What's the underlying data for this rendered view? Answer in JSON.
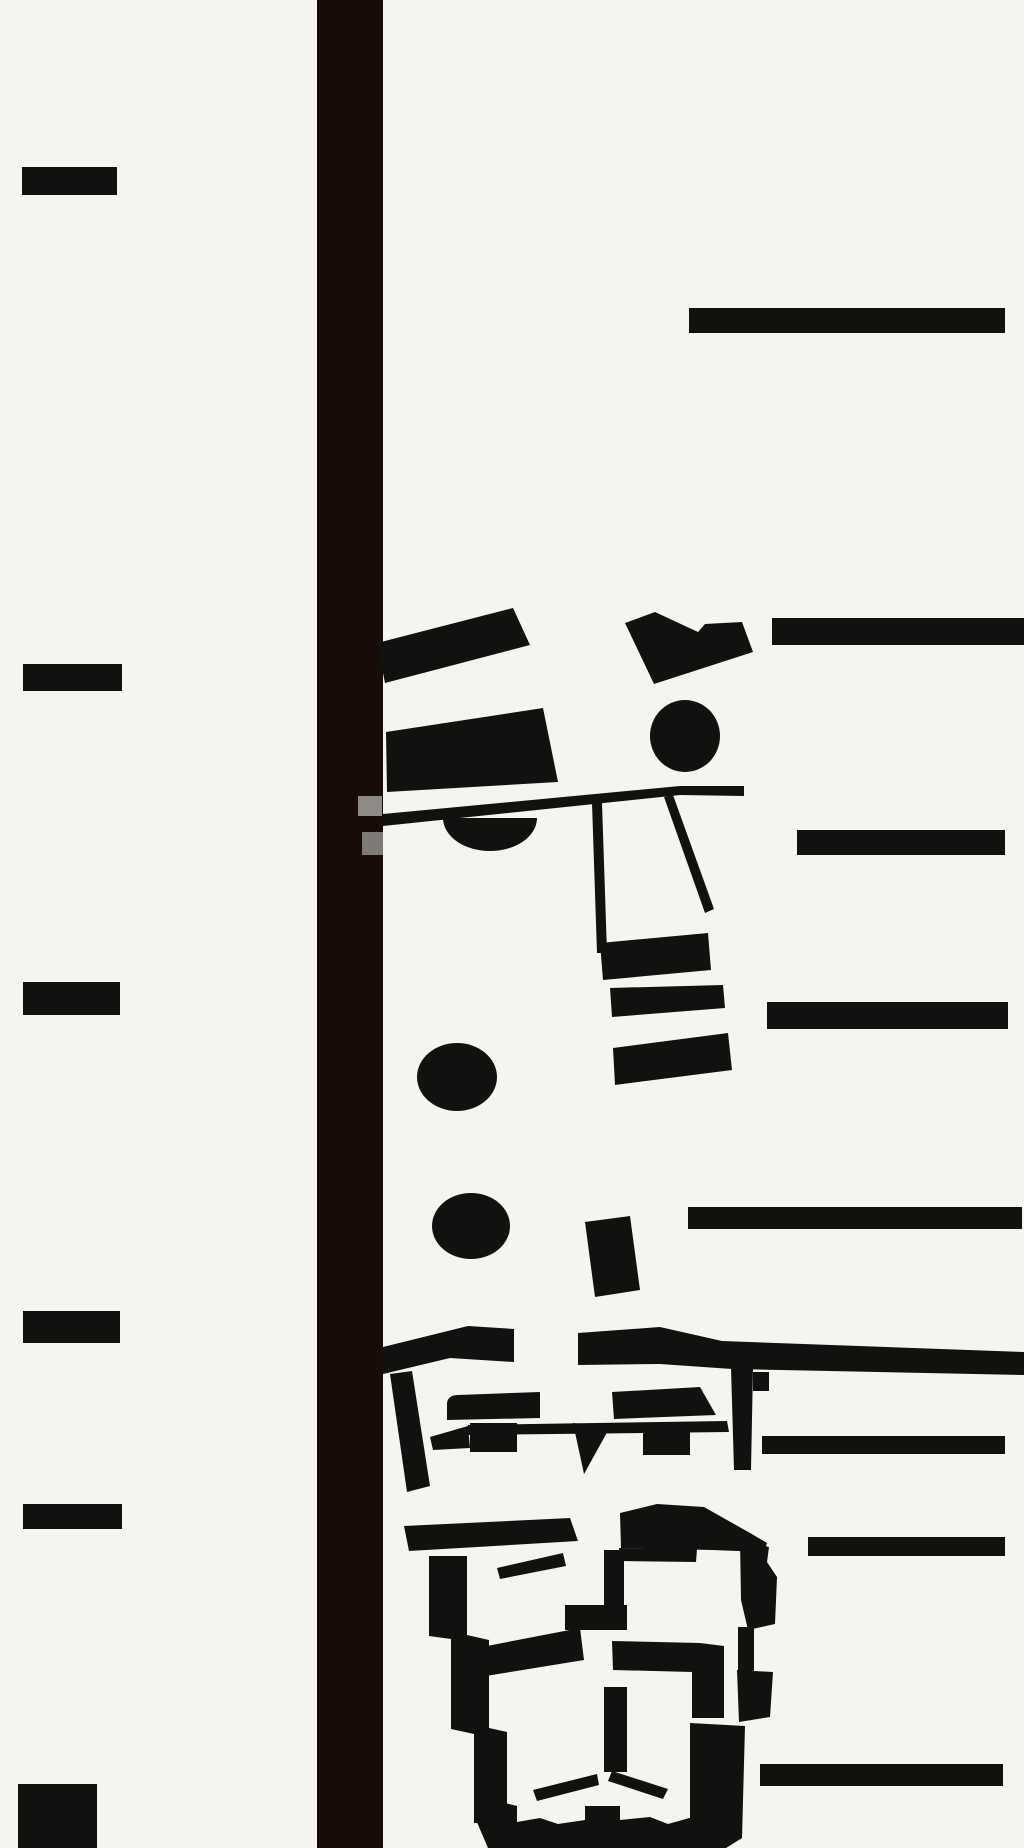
{
  "canvas": {
    "width": 1024,
    "height": 1848
  },
  "palette": {
    "background": "#f5f4f1",
    "ink": "#121110",
    "bar": "#170c08",
    "gray1": "#8e8b87",
    "gray2": "#7e7a76"
  },
  "shapes": [
    {
      "name": "left-tick-1",
      "kind": "rect",
      "x": 22,
      "y": 167,
      "w": 95,
      "h": 28
    },
    {
      "name": "left-tick-2",
      "kind": "rect",
      "x": 23,
      "y": 664,
      "w": 99,
      "h": 27
    },
    {
      "name": "left-tick-3",
      "kind": "rect",
      "x": 23,
      "y": 982,
      "w": 97,
      "h": 33
    },
    {
      "name": "left-tick-4",
      "kind": "rect",
      "x": 23,
      "y": 1311,
      "w": 97,
      "h": 32
    },
    {
      "name": "left-tick-5",
      "kind": "rect",
      "x": 23,
      "y": 1504,
      "w": 99,
      "h": 25
    },
    {
      "name": "left-corner-square",
      "kind": "rect",
      "x": 18,
      "y": 1784,
      "w": 79,
      "h": 64
    },
    {
      "name": "vertical-bar",
      "kind": "rect",
      "x": 317,
      "y": 0,
      "w": 66,
      "h": 1848,
      "fill": "bar"
    },
    {
      "name": "right-bar-1",
      "kind": "rect",
      "x": 689,
      "y": 308,
      "w": 316,
      "h": 25
    },
    {
      "name": "right-bar-2",
      "kind": "rect",
      "x": 772,
      "y": 618,
      "w": 252,
      "h": 27
    },
    {
      "name": "right-bar-3",
      "kind": "rect",
      "x": 797,
      "y": 830,
      "w": 208,
      "h": 25
    },
    {
      "name": "right-bar-4",
      "kind": "rect",
      "x": 767,
      "y": 1002,
      "w": 241,
      "h": 27
    },
    {
      "name": "right-bar-5",
      "kind": "rect",
      "x": 688,
      "y": 1207,
      "w": 334,
      "h": 22
    },
    {
      "name": "right-bar-6",
      "kind": "rect",
      "x": 762,
      "y": 1436,
      "w": 243,
      "h": 18
    },
    {
      "name": "right-bar-7",
      "kind": "rect",
      "x": 808,
      "y": 1537,
      "w": 197,
      "h": 19
    },
    {
      "name": "right-bar-8",
      "kind": "rect",
      "x": 760,
      "y": 1764,
      "w": 243,
      "h": 22
    },
    {
      "name": "face1-brow",
      "kind": "poly",
      "pts": [
        [
          377,
          643
        ],
        [
          513,
          608
        ],
        [
          530,
          645
        ],
        [
          385,
          683
        ]
      ]
    },
    {
      "name": "face1-cap",
      "kind": "poly",
      "pts": [
        [
          625,
          623
        ],
        [
          655,
          612
        ],
        [
          698,
          632
        ],
        [
          705,
          624
        ],
        [
          742,
          622
        ],
        [
          753,
          652
        ],
        [
          654,
          684
        ]
      ]
    },
    {
      "name": "face1-right-eye",
      "kind": "ellipse",
      "cx": 685,
      "cy": 736,
      "rx": 35,
      "ry": 36
    },
    {
      "name": "face1-brim",
      "kind": "poly",
      "pts": [
        [
          386,
          732
        ],
        [
          543,
          708
        ],
        [
          558,
          782
        ],
        [
          387,
          792
        ]
      ]
    },
    {
      "name": "face1-browline",
      "kind": "poly",
      "pts": [
        [
          383,
          814
        ],
        [
          680,
          786
        ],
        [
          744,
          786
        ],
        [
          744,
          796
        ],
        [
          680,
          795
        ],
        [
          383,
          826
        ]
      ]
    },
    {
      "name": "face1-left-eye",
      "kind": "path",
      "d": "M443,818 L537,818 A47,33 0 0 1 443,818 Z"
    },
    {
      "name": "face1-nose-left",
      "kind": "poly",
      "pts": [
        [
          592,
          803
        ],
        [
          602,
          803
        ],
        [
          607,
          953
        ],
        [
          597,
          953
        ]
      ]
    },
    {
      "name": "face1-nose-right",
      "kind": "poly",
      "pts": [
        [
          664,
          797
        ],
        [
          673,
          795
        ],
        [
          714,
          909
        ],
        [
          705,
          913
        ]
      ]
    },
    {
      "name": "face1-nose-base",
      "kind": "poly",
      "pts": [
        [
          600,
          943
        ],
        [
          708,
          933
        ],
        [
          711,
          970
        ],
        [
          603,
          980
        ]
      ]
    },
    {
      "name": "face1-mouth",
      "kind": "poly",
      "pts": [
        [
          610,
          988
        ],
        [
          723,
          985
        ],
        [
          725,
          1008
        ],
        [
          612,
          1017
        ]
      ]
    },
    {
      "name": "face1-chin-bar",
      "kind": "poly",
      "pts": [
        [
          613,
          1048
        ],
        [
          728,
          1033
        ],
        [
          732,
          1070
        ],
        [
          615,
          1085
        ]
      ]
    },
    {
      "name": "gray-chip-upper",
      "kind": "rect",
      "x": 358,
      "y": 796,
      "w": 24,
      "h": 20,
      "fill": "gray1"
    },
    {
      "name": "gray-chip-lower",
      "kind": "rect",
      "x": 362,
      "y": 832,
      "w": 21,
      "h": 23,
      "fill": "gray2"
    },
    {
      "name": "dot-upper",
      "kind": "ellipse",
      "cx": 457,
      "cy": 1077,
      "rx": 40,
      "ry": 34
    },
    {
      "name": "dot-lower",
      "kind": "ellipse",
      "cx": 471,
      "cy": 1226,
      "rx": 39,
      "ry": 33
    },
    {
      "name": "tilted-block",
      "kind": "poly",
      "pts": [
        [
          585,
          1222
        ],
        [
          630,
          1216
        ],
        [
          640,
          1290
        ],
        [
          595,
          1297
        ]
      ]
    },
    {
      "name": "face2-brow-left",
      "kind": "poly",
      "pts": [
        [
          383,
          1347
        ],
        [
          468,
          1326
        ],
        [
          514,
          1329
        ],
        [
          514,
          1362
        ],
        [
          450,
          1358
        ],
        [
          383,
          1374
        ]
      ]
    },
    {
      "name": "face2-brow-right",
      "kind": "poly",
      "pts": [
        [
          578,
          1333
        ],
        [
          660,
          1327
        ],
        [
          722,
          1341
        ],
        [
          1024,
          1352
        ],
        [
          1024,
          1375
        ],
        [
          732,
          1369
        ],
        [
          660,
          1364
        ],
        [
          578,
          1365
        ]
      ]
    },
    {
      "name": "face2-temple-left",
      "kind": "poly",
      "pts": [
        [
          390,
          1374
        ],
        [
          412,
          1371
        ],
        [
          430,
          1486
        ],
        [
          407,
          1492
        ]
      ]
    },
    {
      "name": "face2-bridge-right",
      "kind": "poly",
      "pts": [
        [
          731,
          1368
        ],
        [
          753,
          1368
        ],
        [
          751,
          1470
        ],
        [
          734,
          1470
        ]
      ]
    },
    {
      "name": "face2-ear-right",
      "kind": "rect",
      "x": 753,
      "y": 1372,
      "w": 16,
      "h": 19
    },
    {
      "name": "face2-lens-left",
      "kind": "path",
      "d": "M447,1420 L447,1403 Q448,1395 458,1395 L540,1392 L540,1418 Z"
    },
    {
      "name": "face2-lens-left-base",
      "kind": "rect",
      "x": 470,
      "y": 1423,
      "w": 47,
      "h": 29
    },
    {
      "name": "face2-hinge-left",
      "kind": "poly",
      "pts": [
        [
          430,
          1437
        ],
        [
          468,
          1426
        ],
        [
          470,
          1448
        ],
        [
          433,
          1450
        ]
      ]
    },
    {
      "name": "face2-lens-right",
      "kind": "poly",
      "pts": [
        [
          612,
          1392
        ],
        [
          700,
          1387
        ],
        [
          716,
          1415
        ],
        [
          614,
          1419
        ]
      ]
    },
    {
      "name": "face2-baseline",
      "kind": "poly",
      "pts": [
        [
          468,
          1425
        ],
        [
          727,
          1421
        ],
        [
          729,
          1432
        ],
        [
          468,
          1435
        ]
      ]
    },
    {
      "name": "face2-tooth-mid",
      "kind": "poly",
      "pts": [
        [
          573,
          1423
        ],
        [
          610,
          1427
        ],
        [
          584,
          1474
        ]
      ]
    },
    {
      "name": "face2-tooth-right",
      "kind": "rect",
      "x": 643,
      "y": 1432,
      "w": 47,
      "h": 23
    },
    {
      "name": "face3-cheekline-upper",
      "kind": "poly",
      "pts": [
        [
          404,
          1526
        ],
        [
          570,
          1518
        ],
        [
          578,
          1541
        ],
        [
          409,
          1551
        ]
      ]
    },
    {
      "name": "face3-hair",
      "kind": "poly",
      "pts": [
        [
          620,
          1513
        ],
        [
          657,
          1504
        ],
        [
          704,
          1507
        ],
        [
          750,
          1533
        ],
        [
          767,
          1543
        ],
        [
          764,
          1552
        ],
        [
          712,
          1550
        ],
        [
          621,
          1548
        ]
      ]
    },
    {
      "name": "face3-side-right",
      "kind": "poly",
      "pts": [
        [
          740,
          1540
        ],
        [
          769,
          1547
        ],
        [
          767,
          1562
        ],
        [
          777,
          1577
        ],
        [
          775,
          1624
        ],
        [
          748,
          1630
        ],
        [
          741,
          1600
        ]
      ]
    },
    {
      "name": "face3-side-right-neck",
      "kind": "rect",
      "x": 738,
      "y": 1627,
      "w": 16,
      "h": 45
    },
    {
      "name": "face3-side-right-low",
      "kind": "poly",
      "pts": [
        [
          737,
          1670
        ],
        [
          773,
          1672
        ],
        [
          770,
          1717
        ],
        [
          739,
          1722
        ]
      ]
    },
    {
      "name": "face3-left-frame",
      "kind": "poly",
      "pts": [
        [
          429,
          1556
        ],
        [
          467,
          1556
        ],
        [
          467,
          1635
        ],
        [
          489,
          1640
        ],
        [
          489,
          1728
        ],
        [
          507,
          1732
        ],
        [
          507,
          1823
        ],
        [
          474,
          1823
        ],
        [
          474,
          1734
        ],
        [
          451,
          1729
        ],
        [
          451,
          1639
        ],
        [
          429,
          1636
        ]
      ]
    },
    {
      "name": "face3-left-eye",
      "kind": "poly",
      "pts": [
        [
          497,
          1568
        ],
        [
          563,
          1553
        ],
        [
          566,
          1566
        ],
        [
          500,
          1579
        ]
      ]
    },
    {
      "name": "face3-right-brow",
      "kind": "poly",
      "pts": [
        [
          619,
          1548
        ],
        [
          697,
          1549
        ],
        [
          696,
          1562
        ],
        [
          620,
          1561
        ]
      ]
    },
    {
      "name": "face3-nose",
      "kind": "rect",
      "x": 604,
      "y": 1550,
      "w": 20,
      "h": 58
    },
    {
      "name": "face3-nose-foot",
      "kind": "rect",
      "x": 565,
      "y": 1605,
      "w": 62,
      "h": 25
    },
    {
      "name": "face3-philtrum",
      "kind": "rect",
      "x": 604,
      "y": 1687,
      "w": 23,
      "h": 85
    },
    {
      "name": "face3-cheekline-left",
      "kind": "poly",
      "pts": [
        [
          456,
          1652
        ],
        [
          580,
          1628
        ],
        [
          584,
          1660
        ],
        [
          461,
          1680
        ]
      ]
    },
    {
      "name": "face3-cheek-right",
      "kind": "poly",
      "pts": [
        [
          612,
          1641
        ],
        [
          700,
          1643
        ],
        [
          724,
          1646
        ],
        [
          724,
          1718
        ],
        [
          692,
          1718
        ],
        [
          692,
          1672
        ],
        [
          613,
          1670
        ]
      ]
    },
    {
      "name": "face3-mustache-left",
      "kind": "poly",
      "pts": [
        [
          533,
          1790
        ],
        [
          597,
          1774
        ],
        [
          599,
          1785
        ],
        [
          537,
          1801
        ]
      ]
    },
    {
      "name": "face3-mustache-right",
      "kind": "poly",
      "pts": [
        [
          608,
          1781
        ],
        [
          612,
          1771
        ],
        [
          668,
          1789
        ],
        [
          663,
          1799
        ]
      ]
    },
    {
      "name": "face3-beard",
      "kind": "poly",
      "pts": [
        [
          474,
          1735
        ],
        [
          505,
          1735
        ],
        [
          505,
          1803
        ],
        [
          517,
          1806
        ],
        [
          517,
          1822
        ],
        [
          540,
          1818
        ],
        [
          558,
          1824
        ],
        [
          585,
          1820
        ],
        [
          585,
          1806
        ],
        [
          620,
          1806
        ],
        [
          620,
          1820
        ],
        [
          650,
          1817
        ],
        [
          668,
          1824
        ],
        [
          693,
          1817
        ],
        [
          693,
          1790
        ],
        [
          703,
          1770
        ],
        [
          740,
          1772
        ],
        [
          737,
          1838
        ],
        [
          726,
          1848
        ],
        [
          488,
          1848
        ],
        [
          476,
          1820
        ]
      ]
    },
    {
      "name": "face3-beard-right",
      "kind": "poly",
      "pts": [
        [
          690,
          1723
        ],
        [
          745,
          1726
        ],
        [
          742,
          1838
        ],
        [
          726,
          1848
        ],
        [
          690,
          1848
        ]
      ]
    }
  ]
}
